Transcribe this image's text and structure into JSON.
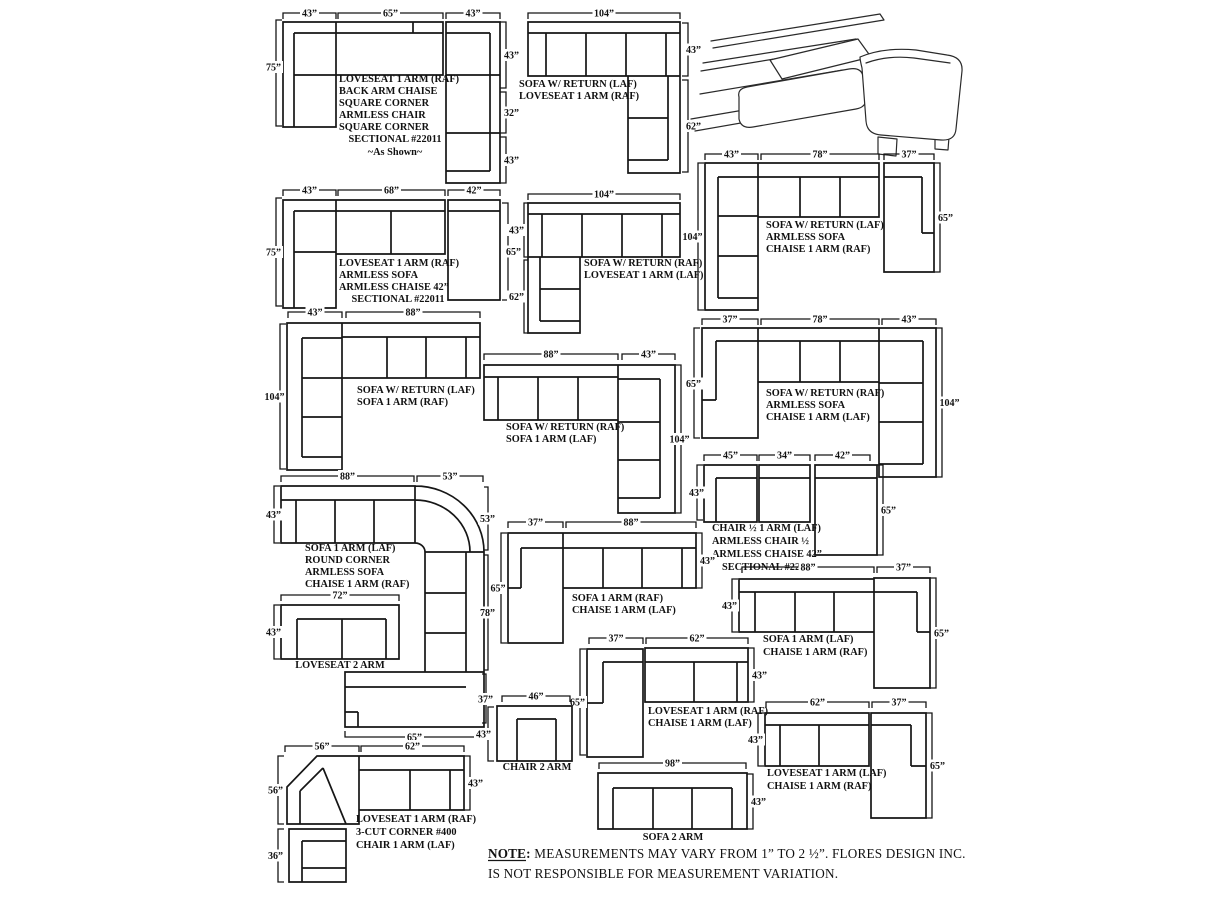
{
  "page": {
    "background": "#ffffff",
    "ink": "#161616"
  },
  "note": {
    "label": "NOTE:",
    "line1": " MEASUREMENTS MAY VARY FROM 1” TO 2 ½”. FLORES DESIGN INC.",
    "line2": "IS NOT RESPONSIBLE FOR MEASUREMENT VARIATION."
  },
  "diagrams": {
    "d1": {
      "labels": [
        "LOVESEAT 1 ARM (RAF)",
        "BACK ARM CHAISE",
        "SQUARE CORNER",
        "ARMLESS CHAIR",
        "SQUARE CORNER",
        "SECTIONAL #22011",
        "~As Shown~"
      ],
      "dims": {
        "top": [
          "43”",
          "65”",
          "43”"
        ],
        "left": [
          "75”"
        ],
        "right": [
          "43”",
          "32”",
          "43”"
        ]
      }
    },
    "d2": {
      "labels": [
        "SOFA W/ RETURN (LAF)",
        "LOVESEAT 1 ARM (RAF)"
      ],
      "dims": {
        "top": [
          "104”"
        ],
        "right": [
          "43”",
          "62”"
        ]
      }
    },
    "d3": {
      "labels": [
        "LOVESEAT 1 ARM (RAF)",
        "ARMLESS SOFA",
        "ARMLESS CHAISE 42”",
        "SECTIONAL #22011"
      ],
      "dims": {
        "top": [
          "43”",
          "68”",
          "42”"
        ],
        "left": [
          "75”"
        ],
        "right": [
          "65”"
        ]
      }
    },
    "d4": {
      "labels": [
        "SOFA W/ RETURN (RAF)",
        "LOVESEAT 1 ARM (LAF)"
      ],
      "dims": {
        "top": [
          "104”"
        ],
        "left": [
          "43”",
          "62”"
        ]
      }
    },
    "d5": {
      "labels": [
        "SOFA W/ RETURN (LAF)",
        "ARMLESS SOFA",
        "CHAISE 1 ARM (RAF)"
      ],
      "dims": {
        "top": [
          "43”",
          "78”",
          "37”"
        ],
        "left": [
          "104”"
        ],
        "right": [
          "65”"
        ]
      }
    },
    "d6": {
      "labels": [
        "SOFA W/ RETURN (LAF)",
        "SOFA 1 ARM (RAF)"
      ],
      "dims": {
        "top": [
          "43”",
          "88”"
        ],
        "left": [
          "104”"
        ]
      }
    },
    "d7": {
      "labels": [
        "SOFA W/ RETURN (RAF)",
        "SOFA 1 ARM (LAF)"
      ],
      "dims": {
        "top": [
          "88”",
          "43”"
        ],
        "right": [
          "104”"
        ]
      }
    },
    "d8": {
      "labels": [
        "SOFA W/ RETURN (RAF)",
        "ARMLESS SOFA",
        "CHAISE 1 ARM (LAF)"
      ],
      "dims": {
        "top": [
          "37”",
          "78”",
          "43”"
        ],
        "left": [
          "65”"
        ],
        "right": [
          "104”"
        ]
      }
    },
    "d9": {
      "labels": [
        "CHAIR ½ 1 ARM (LAF)",
        "ARMLESS CHAIR ½",
        "ARMLESS CHAISE 42”",
        "SECTIONAL #22011"
      ],
      "dims": {
        "top": [
          "45”",
          "34”",
          "42”"
        ],
        "left": [
          "43”"
        ],
        "right": [
          "65”"
        ]
      }
    },
    "d10": {
      "labels": [
        "SOFA 1 ARM (LAF)",
        "ROUND CORNER",
        "ARMLESS SOFA",
        "CHAISE 1 ARM (RAF)"
      ],
      "dims": {
        "top": [
          "88”",
          "53”"
        ],
        "left": [
          "43”"
        ],
        "right": [
          "53”",
          "78”",
          "37”"
        ],
        "bottom": [
          "65”"
        ]
      }
    },
    "d11": {
      "labels": [
        "LOVESEAT 2 ARM"
      ],
      "dims": {
        "top": [
          "72”"
        ],
        "left": [
          "43”"
        ]
      }
    },
    "d12": {
      "labels": [
        "SOFA 1 ARM (RAF)",
        "CHAISE 1 ARM (LAF)"
      ],
      "dims": {
        "top": [
          "37”",
          "88”"
        ],
        "left": [
          "65”"
        ],
        "right": [
          "43”"
        ]
      }
    },
    "d13": {
      "labels": [
        "SOFA 1 ARM (LAF)",
        "CHAISE 1 ARM (RAF)"
      ],
      "dims": {
        "top": [
          "88”",
          "37”"
        ],
        "left": [
          "43”"
        ],
        "right": [
          "65”"
        ]
      }
    },
    "d14": {
      "labels": [
        "LOVESEAT 1 ARM (RAF)",
        "CHAISE 1 ARM (LAF)"
      ],
      "dims": {
        "top": [
          "37”",
          "62”"
        ],
        "left": [
          "65”"
        ],
        "right": [
          "43”"
        ]
      }
    },
    "d15": {
      "labels": [
        "LOVESEAT 1 ARM (LAF)",
        "CHAISE 1 ARM (RAF)"
      ],
      "dims": {
        "top": [
          "62”",
          "37”"
        ],
        "left": [
          "43”"
        ],
        "right": [
          "65”"
        ]
      }
    },
    "d16": {
      "labels": [
        "CHAIR 2 ARM"
      ],
      "dims": {
        "top": [
          "46”"
        ],
        "left": [
          "43”"
        ]
      }
    },
    "d17": {
      "labels": [
        "LOVESEAT 1 ARM (RAF)",
        "3-CUT CORNER #400",
        "CHAIR 1 ARM (LAF)"
      ],
      "dims": {
        "top": [
          "56”",
          "62”"
        ],
        "left": [
          "56”",
          "36”"
        ],
        "right": [
          "43”"
        ]
      }
    },
    "d18": {
      "labels": [
        "SOFA 2 ARM"
      ],
      "dims": {
        "top": [
          "98”"
        ],
        "right": [
          "43”"
        ]
      }
    }
  }
}
